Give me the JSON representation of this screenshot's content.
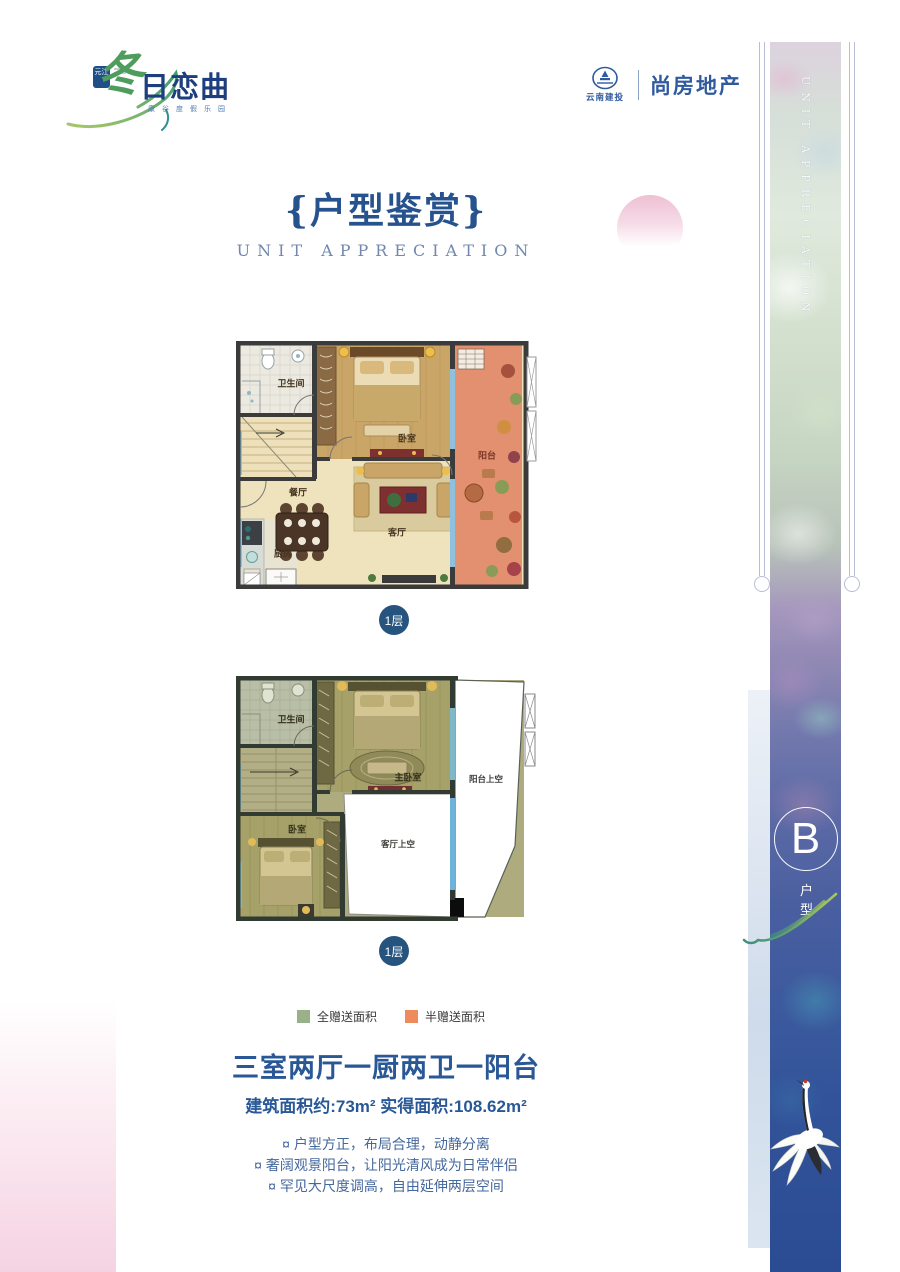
{
  "brand": {
    "seal": "元江",
    "logo_accent": "冬",
    "logo_text": "日恋曲",
    "tagline": "康谷度假乐园",
    "developer": "云南建投",
    "agency": "尚房地产"
  },
  "header": {
    "title": "{户型鉴赏}",
    "subtitle": "UNIT APPRECIATION"
  },
  "band": {
    "vertical_text": "UNIT APPRECIATION",
    "unit_letter": "B",
    "unit_type": "户型"
  },
  "floor_plans": [
    {
      "badge": "1层",
      "rooms": {
        "bathroom": "卫生间",
        "bedroom": "卧室",
        "balcony": "阳台",
        "dining": "餐厅",
        "living": "客厅",
        "kitchen": "厨房"
      }
    },
    {
      "badge": "1层",
      "rooms": {
        "bathroom": "卫生间",
        "master_bedroom": "主卧室",
        "balcony_void": "阳台上空",
        "bedroom": "卧室",
        "living_void": "客厅上空"
      }
    }
  ],
  "legend": {
    "items": [
      {
        "label": "全赠送面积",
        "color": "#9ab188"
      },
      {
        "label": "半赠送面积",
        "color": "#ef8a5c"
      }
    ]
  },
  "summary": {
    "layout_title": "三室两厅一厨两卫一阳台",
    "area_info": "建筑面积约:73m² 实得面积:108.62m²",
    "features": [
      "¤ 户型方正，布局合理，动静分离",
      "¤ 奢阔观景阳台，让阳光清风成为日常伴侣",
      "¤ 罕见大尺度调高，自由延伸两层空间"
    ]
  },
  "colors": {
    "title_blue": "#26528e",
    "text_blue": "#44679c",
    "badge_blue": "#27547e",
    "full_gift_green": "#9ab188",
    "half_gift_orange": "#ef8a5c"
  }
}
